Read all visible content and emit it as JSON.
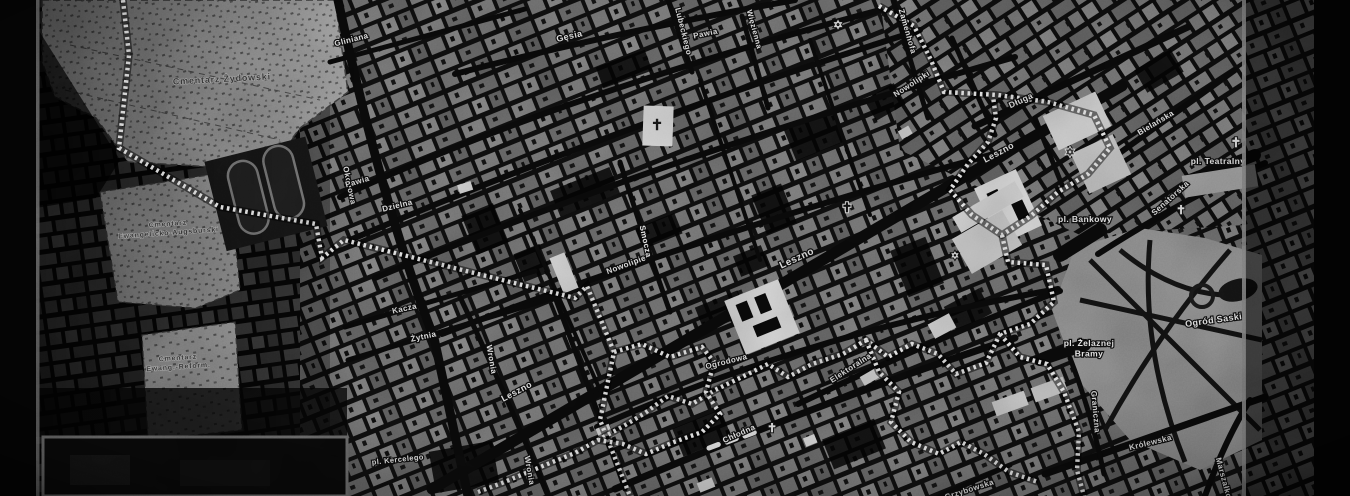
{
  "map": {
    "colors": {
      "boundary": "#f2f2f2",
      "street": "#0b0b0b",
      "block_gray": "#838383",
      "cemetery_light": "#b1b1b1",
      "frame_line": "#7d7d7d",
      "background": "#050505",
      "label_white": "#f4f4f4",
      "label_dark": "#3c3c3c"
    },
    "street_labels": [
      {
        "text": "Gliniana",
        "x": 352,
        "y": 42,
        "rot": -14,
        "size": 8
      },
      {
        "text": "Gęsia",
        "x": 570,
        "y": 39,
        "rot": -13,
        "size": 9
      },
      {
        "text": "Lubeckiego",
        "x": 681,
        "y": 32,
        "rot": 76,
        "size": 8
      },
      {
        "text": "Pawia",
        "x": 706,
        "y": 36,
        "rot": -12,
        "size": 8
      },
      {
        "text": "Więzienna",
        "x": 752,
        "y": 30,
        "rot": 75,
        "size": 7.5
      },
      {
        "text": "Zamenhofa",
        "x": 905,
        "y": 32,
        "rot": 74,
        "size": 8
      },
      {
        "text": "Nowolipki",
        "x": 913,
        "y": 86,
        "rot": -33,
        "size": 8
      },
      {
        "text": "Długa",
        "x": 1022,
        "y": 103,
        "rot": -25,
        "size": 8.5
      },
      {
        "text": "Bielańska",
        "x": 1157,
        "y": 125,
        "rot": -31,
        "size": 8
      },
      {
        "text": "Okopowa",
        "x": 347,
        "y": 186,
        "rot": 78,
        "size": 8
      },
      {
        "text": "Pawia",
        "x": 358,
        "y": 184,
        "rot": -16,
        "size": 8
      },
      {
        "text": "Dzielna",
        "x": 398,
        "y": 208,
        "rot": -14,
        "size": 8
      },
      {
        "text": "Senatorska",
        "x": 1172,
        "y": 200,
        "rot": -42,
        "size": 8
      },
      {
        "text": "Smocza",
        "x": 643,
        "y": 242,
        "rot": 78,
        "size": 8
      },
      {
        "text": "Nowolipie",
        "x": 627,
        "y": 267,
        "rot": -20,
        "size": 8
      },
      {
        "text": "Leszno",
        "x": 798,
        "y": 261,
        "rot": -25,
        "size": 10
      },
      {
        "text": "Leszno",
        "x": 1000,
        "y": 155,
        "rot": -28,
        "size": 9
      },
      {
        "text": "Leszno",
        "x": 518,
        "y": 394,
        "rot": -28,
        "size": 9
      },
      {
        "text": "Kacza",
        "x": 405,
        "y": 311,
        "rot": -12,
        "size": 8
      },
      {
        "text": "Żytnia",
        "x": 424,
        "y": 339,
        "rot": -12,
        "size": 8
      },
      {
        "text": "Wronia",
        "x": 489,
        "y": 360,
        "rot": 80,
        "size": 8
      },
      {
        "text": "Wronia",
        "x": 527,
        "y": 471,
        "rot": 80,
        "size": 8
      },
      {
        "text": "Ogrodowa",
        "x": 727,
        "y": 364,
        "rot": -14,
        "size": 8
      },
      {
        "text": "Elektoralna",
        "x": 852,
        "y": 370,
        "rot": -33,
        "size": 8
      },
      {
        "text": "Chłodna",
        "x": 740,
        "y": 436,
        "rot": -24,
        "size": 8
      },
      {
        "text": "pl. Kercelego",
        "x": 398,
        "y": 462,
        "rot": -6,
        "size": 7.5
      },
      {
        "text": "Graniczna",
        "x": 1093,
        "y": 412,
        "rot": 85,
        "size": 8
      },
      {
        "text": "Królewska",
        "x": 1151,
        "y": 445,
        "rot": -14,
        "size": 8
      },
      {
        "text": "Grzybowska",
        "x": 970,
        "y": 492,
        "rot": -18,
        "size": 8
      },
      {
        "text": "Marszałkowska",
        "x": 1224,
        "y": 489,
        "rot": 75,
        "size": 8
      }
    ],
    "place_labels": [
      {
        "text": "pl. Teatralny",
        "x": 1218,
        "y": 164,
        "rot": 0,
        "size": 8.5
      },
      {
        "text": "pl. Bankowy",
        "x": 1085,
        "y": 222,
        "rot": 0,
        "size": 8.5
      },
      {
        "text": "Ogród Saski",
        "x": 1214,
        "y": 323,
        "rot": -8,
        "size": 9
      },
      {
        "lines": [
          "pl. Żelaznej",
          "Bramy"
        ],
        "x": 1089,
        "y": 346,
        "rot": 0,
        "size": 8.5
      }
    ],
    "area_labels": [
      {
        "lines": [
          "Cmentarz Żydowski"
        ],
        "x": 222,
        "y": 82,
        "rot": -3,
        "size": 9
      },
      {
        "lines": [
          "Cmentarz",
          "Ewangelicko-Augsburski"
        ],
        "x": 168,
        "y": 226,
        "rot": -4,
        "size": 7
      },
      {
        "lines": [
          "Cmentarz",
          "Ewang.-Reform."
        ],
        "x": 178,
        "y": 360,
        "rot": -4,
        "size": 7
      }
    ],
    "icons": [
      {
        "kind": "church-cross",
        "char": "✝",
        "x": 657,
        "y": 130,
        "size": 15,
        "color": "#1a1a1a",
        "halo": "#e8e8e8"
      },
      {
        "kind": "church-cross",
        "char": "✝",
        "x": 847,
        "y": 212,
        "size": 13,
        "color": "#111111",
        "halo": "#dddddd"
      },
      {
        "kind": "church-cross",
        "char": "✝",
        "x": 772,
        "y": 432,
        "size": 12,
        "color": "#f0f0f0",
        "halo": "#1a1a1a"
      },
      {
        "kind": "church-cross",
        "char": "✝",
        "x": 1236,
        "y": 147,
        "size": 13,
        "color": "#f0f0f0",
        "halo": "#1a1a1a"
      },
      {
        "kind": "church-cross",
        "char": "✝",
        "x": 1181,
        "y": 214,
        "size": 12,
        "color": "#f0f0f0",
        "halo": "#1a1a1a"
      },
      {
        "kind": "star-of-david",
        "char": "✡",
        "x": 838,
        "y": 29,
        "size": 12,
        "color": "#eeeeee",
        "halo": "#111111"
      },
      {
        "kind": "star-of-david",
        "char": "✡",
        "x": 1070,
        "y": 156,
        "size": 11,
        "color": "#333333",
        "halo": "#dddddd"
      },
      {
        "kind": "star-of-david",
        "char": "✡",
        "x": 955,
        "y": 259,
        "size": 10,
        "color": "#e8e8e8",
        "halo": "#111111"
      }
    ]
  }
}
